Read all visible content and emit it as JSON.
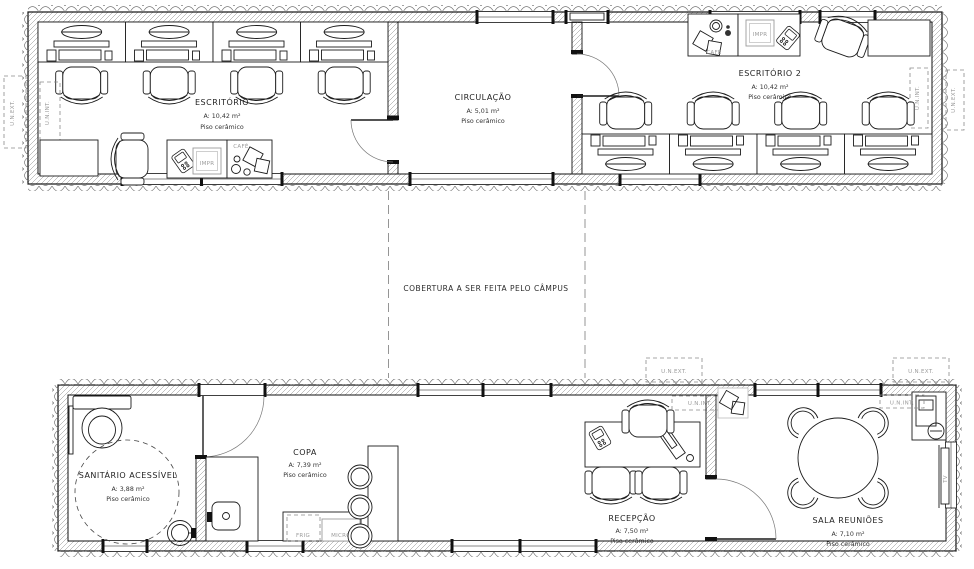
{
  "drawing": {
    "note": "COBERTURA A SER FEITA PELO CÂMPUS",
    "rooms": {
      "escritorio": {
        "name": "ESCRITÓRIO",
        "area": "A: 10,42 m²",
        "floor": "Piso cerâmico"
      },
      "circulacao": {
        "name": "CIRCULAÇÃO",
        "area": "A: 5,01 m²",
        "floor": "Piso cerâmico"
      },
      "escritorio2": {
        "name": "ESCRITÓRIO 2",
        "area": "A: 10,42 m²",
        "floor": "Piso cerâmico"
      },
      "sanitario": {
        "name": "SANITÁRIO ACESSÍVEL",
        "area": "A: 3,88 m²",
        "floor": "Piso cerâmico"
      },
      "copa": {
        "name": "COPA",
        "area": "A: 7,39 m²",
        "floor": "Piso cerâmico"
      },
      "recepcao": {
        "name": "RECEPÇÃO",
        "area": "A: 7,50 m²",
        "floor": "Piso cerâmico"
      },
      "sala_reunioes": {
        "name": "SALA REUNIÕES",
        "area": "A: 7,10 m²",
        "floor": "Piso cerâmico"
      }
    },
    "labels": {
      "printer": "IMPR",
      "cafe": "CAFÉ",
      "fridge": "FRIG",
      "microwave": "MICRO",
      "tv": "TV",
      "ac_indoor": "U.N.INT.",
      "ac_outdoor": "U.N.EXT."
    },
    "colors": {
      "line": "#1c1c1c",
      "muted": "#9b9b9b",
      "background": "#ffffff"
    }
  }
}
